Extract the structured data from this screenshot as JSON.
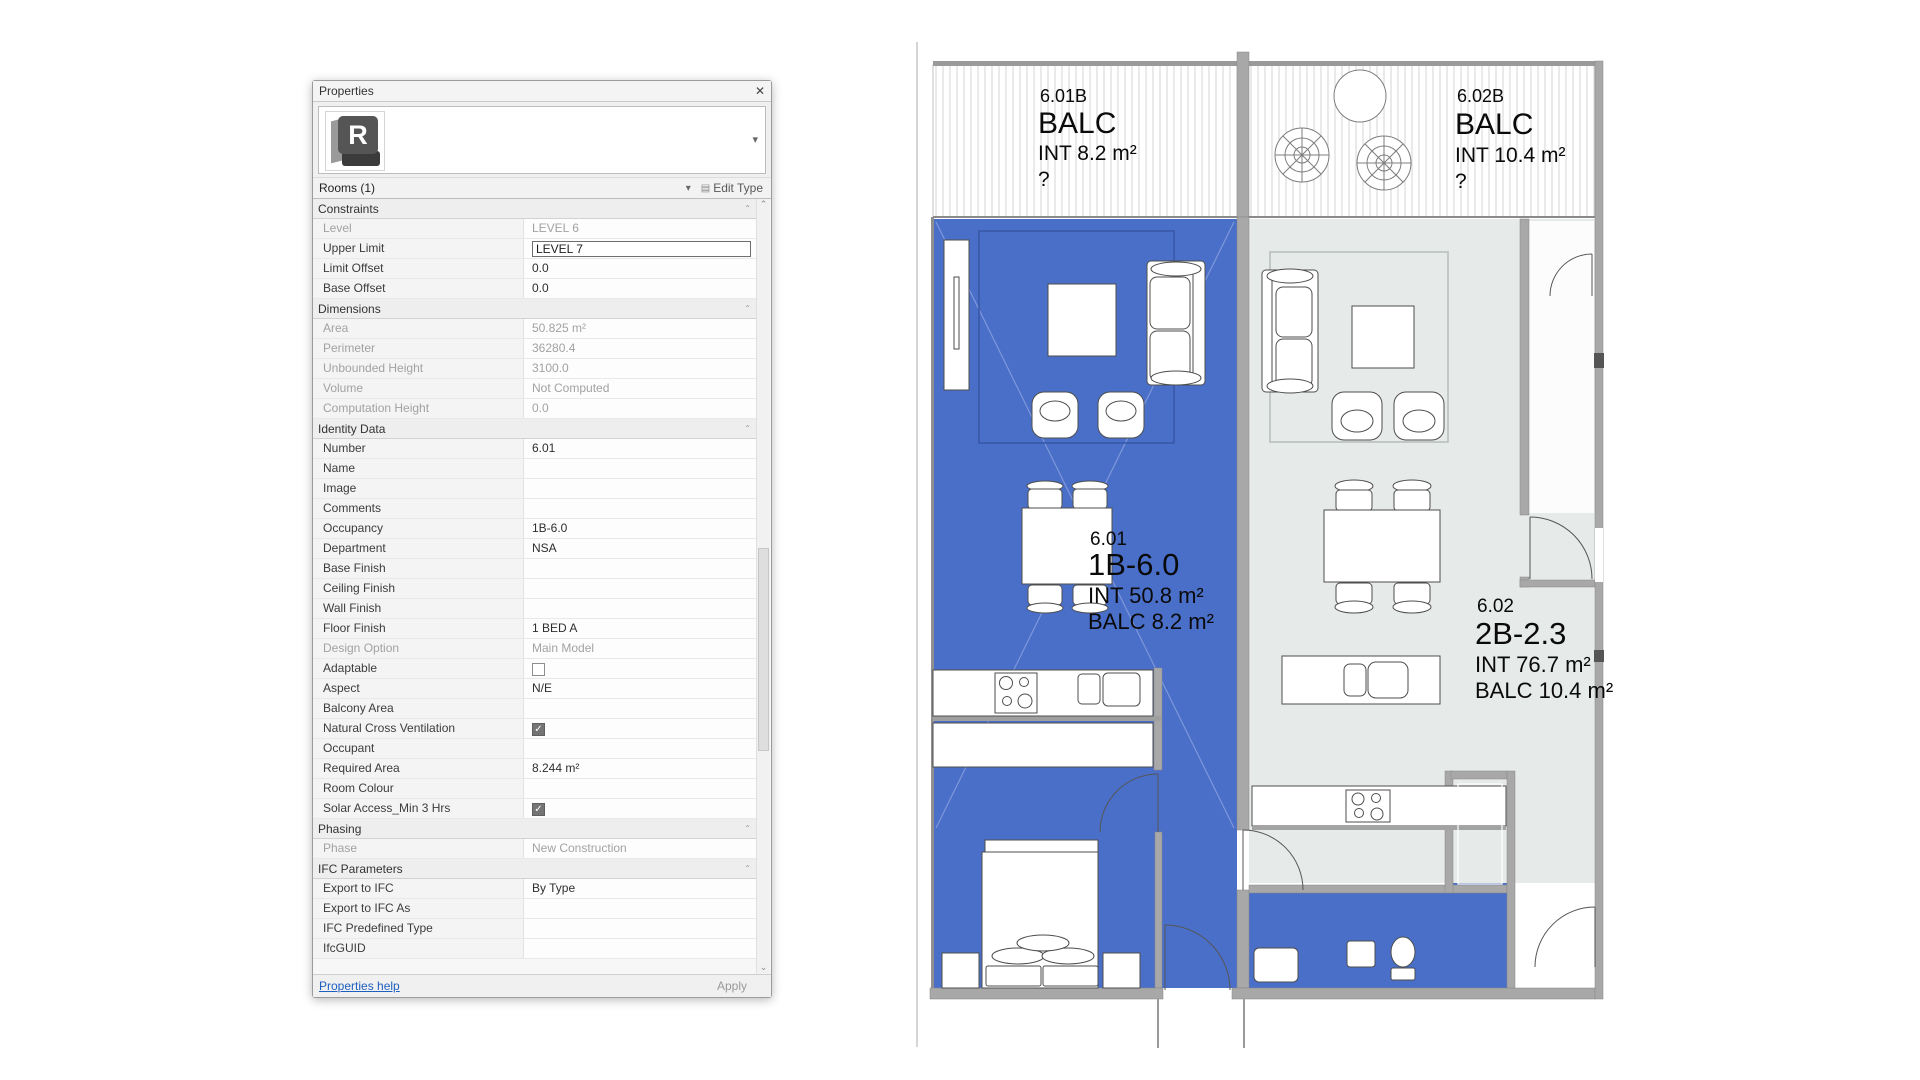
{
  "panel": {
    "title": "Properties",
    "combo": {
      "label": "Rooms (1)"
    },
    "edit_type_label": "Edit Type",
    "footer": {
      "help": "Properties help",
      "apply": "Apply"
    },
    "rows": [
      {
        "label": "Constraints",
        "value": "",
        "type": "section"
      },
      {
        "label": "Level",
        "value": "LEVEL 6",
        "type": "readonly"
      },
      {
        "label": "Upper Limit",
        "value": "LEVEL 7",
        "type": "input"
      },
      {
        "label": "Limit Offset",
        "value": "0.0",
        "type": "text"
      },
      {
        "label": "Base Offset",
        "value": "0.0",
        "type": "text"
      },
      {
        "label": "Dimensions",
        "value": "",
        "type": "section"
      },
      {
        "label": "Area",
        "value": "50.825 m²",
        "type": "readonly"
      },
      {
        "label": "Perimeter",
        "value": "36280.4",
        "type": "readonly"
      },
      {
        "label": "Unbounded Height",
        "value": "3100.0",
        "type": "readonly"
      },
      {
        "label": "Volume",
        "value": "Not Computed",
        "type": "readonly"
      },
      {
        "label": "Computation Height",
        "value": "0.0",
        "type": "readonly"
      },
      {
        "label": "Identity Data",
        "value": "",
        "type": "section"
      },
      {
        "label": "Number",
        "value": "6.01",
        "type": "text"
      },
      {
        "label": "Name",
        "value": "",
        "type": "text"
      },
      {
        "label": "Image",
        "value": "",
        "type": "text"
      },
      {
        "label": "Comments",
        "value": "",
        "type": "text"
      },
      {
        "label": "Occupancy",
        "value": "1B-6.0",
        "type": "text"
      },
      {
        "label": "Department",
        "value": "NSA",
        "type": "text"
      },
      {
        "label": "Base Finish",
        "value": "",
        "type": "text"
      },
      {
        "label": "Ceiling Finish",
        "value": "",
        "type": "text"
      },
      {
        "label": "Wall Finish",
        "value": "",
        "type": "text"
      },
      {
        "label": "Floor Finish",
        "value": "1 BED A",
        "type": "text"
      },
      {
        "label": "Design Option",
        "value": "Main Model",
        "type": "readonly"
      },
      {
        "label": "Adaptable",
        "value": "",
        "type": "checkbox",
        "checked": false
      },
      {
        "label": "Aspect",
        "value": "N/E",
        "type": "text"
      },
      {
        "label": "Balcony Area",
        "value": "",
        "type": "text"
      },
      {
        "label": "Natural Cross Ventilation",
        "value": "",
        "type": "checkbox",
        "checked": true
      },
      {
        "label": "Occupant",
        "value": "",
        "type": "text"
      },
      {
        "label": "Required Area",
        "value": "8.244 m²",
        "type": "text"
      },
      {
        "label": "Room Colour",
        "value": "",
        "type": "text"
      },
      {
        "label": "Solar Access_Min 3 Hrs",
        "value": "",
        "type": "checkbox",
        "checked": true
      },
      {
        "label": "Phasing",
        "value": "",
        "type": "section"
      },
      {
        "label": "Phase",
        "value": "New Construction",
        "type": "readonly"
      },
      {
        "label": "IFC Parameters",
        "value": "",
        "type": "section"
      },
      {
        "label": "Export to IFC",
        "value": "By Type",
        "type": "text"
      },
      {
        "label": "Export to IFC As",
        "value": "",
        "type": "text"
      },
      {
        "label": "IFC Predefined Type",
        "value": "",
        "type": "text"
      },
      {
        "label": "IfcGUID",
        "value": "",
        "type": "text"
      }
    ]
  },
  "plan": {
    "colors": {
      "selected": "#4a6fc8",
      "neighbor": "#e6eae8",
      "wall": "#a8a8a8"
    },
    "balcony1": {
      "number": "6.01B",
      "tag": "BALC",
      "area": "INT 8.2 m²",
      "q": "?"
    },
    "balcony2": {
      "number": "6.02B",
      "tag": "BALC",
      "area": "INT 10.4 m²",
      "q": "?"
    },
    "room1": {
      "number": "6.01",
      "type": "1B-6.0",
      "int": "INT 50.8 m²",
      "balc": "BALC 8.2 m²"
    },
    "room2": {
      "number": "6.02",
      "type": "2B-2.3",
      "int": "INT 76.7 m²",
      "balc": "BALC 10.4 m²"
    }
  }
}
